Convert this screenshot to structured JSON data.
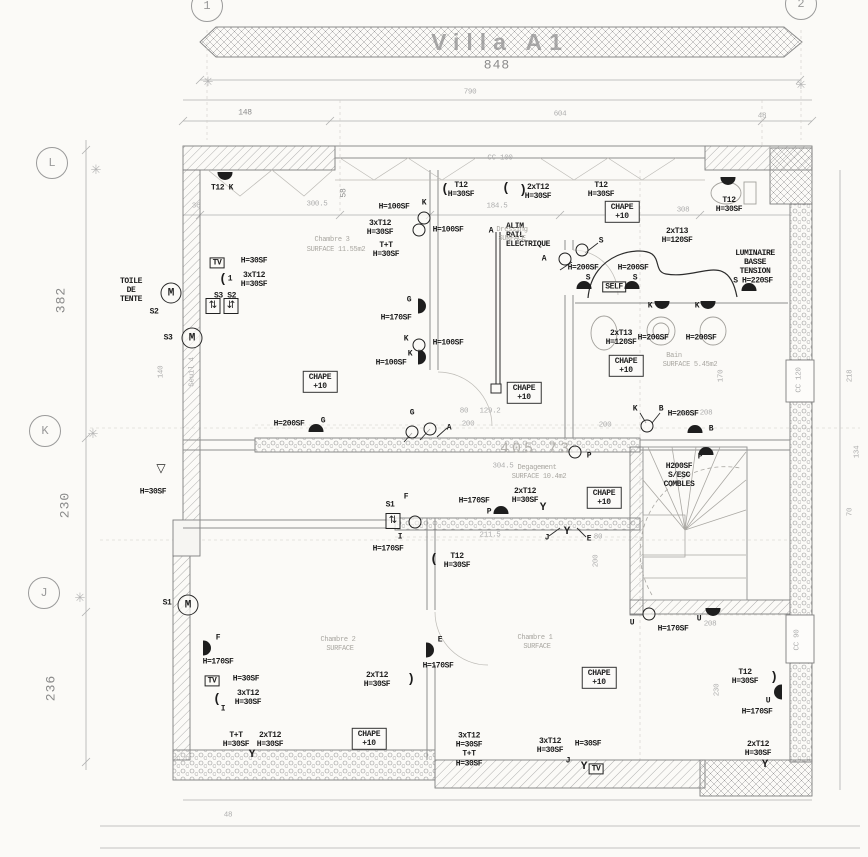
{
  "banner": {
    "title": "Villa A1"
  },
  "grid_bubbles": [
    {
      "label": "1",
      "x": 207,
      "y": 6
    },
    {
      "label": "2",
      "x": 801,
      "y": 4
    },
    {
      "label": "L",
      "x": 52,
      "y": 163
    },
    {
      "label": "K",
      "x": 45,
      "y": 431
    },
    {
      "label": "J",
      "x": 44,
      "y": 593
    }
  ],
  "survey_markers": [
    {
      "x": 208,
      "y": 82
    },
    {
      "x": 801,
      "y": 85
    },
    {
      "x": 96,
      "y": 170
    },
    {
      "x": 93,
      "y": 434
    },
    {
      "x": 80,
      "y": 598
    }
  ],
  "dimensions": [
    {
      "t": "848",
      "x": 497,
      "y": 66,
      "cls": "dim-big"
    },
    {
      "t": "790",
      "x": 470,
      "y": 93,
      "cls": "dim-faint"
    },
    {
      "t": "148",
      "x": 245,
      "y": 113,
      "cls": "dim"
    },
    {
      "t": "604",
      "x": 560,
      "y": 115,
      "cls": "dim-faint"
    },
    {
      "t": "48",
      "x": 762,
      "y": 117,
      "cls": "dim-faint"
    },
    {
      "t": "382",
      "x": 62,
      "y": 300,
      "cls": "dim-big",
      "rot": -90
    },
    {
      "t": "230",
      "x": 66,
      "y": 505,
      "cls": "dim-big",
      "rot": -90
    },
    {
      "t": "236",
      "x": 52,
      "y": 688,
      "cls": "dim-big",
      "rot": -90
    },
    {
      "t": "36",
      "x": 196,
      "y": 207,
      "cls": "dim-faint"
    },
    {
      "t": "300.5",
      "x": 317,
      "y": 205,
      "cls": "dim-faint"
    },
    {
      "t": "58",
      "x": 344,
      "y": 193,
      "cls": "dim",
      "rot": -90
    },
    {
      "t": "184.5",
      "x": 497,
      "y": 207,
      "cls": "dim-faint"
    },
    {
      "t": "CC 100",
      "x": 500,
      "y": 159,
      "cls": "dim-faint"
    },
    {
      "t": "308",
      "x": 683,
      "y": 211,
      "cls": "dim-faint"
    },
    {
      "t": "80",
      "x": 464,
      "y": 412,
      "cls": "dim-faint"
    },
    {
      "t": "129.2",
      "x": 490,
      "y": 412,
      "cls": "dim-faint"
    },
    {
      "t": "200",
      "x": 468,
      "y": 425,
      "cls": "dim-faint"
    },
    {
      "t": "76",
      "x": 682,
      "y": 415,
      "cls": "dim-faint"
    },
    {
      "t": "200",
      "x": 605,
      "y": 426,
      "cls": "dim-faint"
    },
    {
      "t": "208",
      "x": 706,
      "y": 414,
      "cls": "dim-faint"
    },
    {
      "t": "211.5",
      "x": 490,
      "y": 536,
      "cls": "dim-faint"
    },
    {
      "t": "80",
      "x": 598,
      "y": 538,
      "cls": "dim-faint"
    },
    {
      "t": "200",
      "x": 597,
      "y": 561,
      "cls": "dim-faint",
      "rot": -90
    },
    {
      "t": "170",
      "x": 722,
      "y": 376,
      "cls": "dim-faint",
      "rot": -90
    },
    {
      "t": "230",
      "x": 718,
      "y": 690,
      "cls": "dim-faint",
      "rot": -90
    },
    {
      "t": "208",
      "x": 710,
      "y": 625,
      "cls": "dim-faint"
    },
    {
      "t": "CC 120",
      "x": 800,
      "y": 380,
      "cls": "dim-faint",
      "rot": -90
    },
    {
      "t": "CC 90",
      "x": 798,
      "y": 640,
      "cls": "dim-faint",
      "rot": -90
    },
    {
      "t": "218",
      "x": 851,
      "y": 376,
      "cls": "dim-faint",
      "rot": -90
    },
    {
      "t": "134",
      "x": 858,
      "y": 452,
      "cls": "dim-faint",
      "rot": -90
    },
    {
      "t": "70",
      "x": 851,
      "y": 512,
      "cls": "dim-faint",
      "rot": -90
    },
    {
      "t": "140",
      "x": 162,
      "y": 372,
      "cls": "dim-faint",
      "rot": -90
    },
    {
      "t": "Seuil 4",
      "x": 193,
      "y": 372,
      "cls": "dim-faint",
      "rot": -90
    },
    {
      "t": "48",
      "x": 228,
      "y": 816,
      "cls": "dim-faint"
    },
    {
      "t": "304.5",
      "x": 503,
      "y": 467,
      "cls": "dim-faint"
    },
    {
      "t": "405 73",
      "x": 536,
      "y": 449,
      "cls": "dim-xl"
    }
  ],
  "room_labels": [
    {
      "t": "Chambre 3",
      "x": 332,
      "y": 240
    },
    {
      "t": "SURFACE  11.55m2",
      "x": 336,
      "y": 250
    },
    {
      "t": "Dressing",
      "x": 512,
      "y": 230
    },
    {
      "t": "SURFACE",
      "x": 512,
      "y": 239
    },
    {
      "t": "Degagement",
      "x": 537,
      "y": 468
    },
    {
      "t": "SURFACE  10.4m2",
      "x": 539,
      "y": 477
    },
    {
      "t": "Bain",
      "x": 674,
      "y": 356
    },
    {
      "t": "SURFACE  5.45m2",
      "x": 690,
      "y": 365
    },
    {
      "t": "Chambre 2",
      "x": 338,
      "y": 640
    },
    {
      "t": "SURFACE",
      "x": 340,
      "y": 649
    },
    {
      "t": "Chambre 1",
      "x": 535,
      "y": 638
    },
    {
      "t": "SURFACE",
      "x": 537,
      "y": 647
    }
  ],
  "chape": {
    "label": "CHAPE\n+10",
    "boxes": [
      {
        "x": 622,
        "y": 212
      },
      {
        "x": 320,
        "y": 382
      },
      {
        "x": 524,
        "y": 393
      },
      {
        "x": 626,
        "y": 366
      },
      {
        "x": 604,
        "y": 498
      },
      {
        "x": 369,
        "y": 739
      },
      {
        "x": 599,
        "y": 678
      }
    ]
  },
  "annotations": [
    {
      "t": "T12  K",
      "x": 222,
      "y": 188
    },
    {
      "t": "H=100SF",
      "x": 394,
      "y": 207
    },
    {
      "t": "K",
      "x": 424,
      "y": 203
    },
    {
      "t": "3xT12\nH=30SF",
      "x": 380,
      "y": 228
    },
    {
      "t": "T+T\nH=30SF",
      "x": 386,
      "y": 250
    },
    {
      "t": "H=100SF",
      "x": 448,
      "y": 230
    },
    {
      "t": "T12\nH=30SF",
      "x": 461,
      "y": 190
    },
    {
      "t": "2xT12\nH=30SF",
      "x": 538,
      "y": 192
    },
    {
      "t": "T12\nH=30SF",
      "x": 601,
      "y": 190
    },
    {
      "t": "T12\nH=30SF",
      "x": 729,
      "y": 205
    },
    {
      "t": "2xT13\nH=120SF",
      "x": 677,
      "y": 236
    },
    {
      "t": "ALIM\nRAIL\nELECTRIQUE",
      "x": 506,
      "y": 236,
      "a": "l"
    },
    {
      "t": "A",
      "x": 491,
      "y": 231
    },
    {
      "t": "A",
      "x": 544,
      "y": 259
    },
    {
      "t": "S",
      "x": 601,
      "y": 241
    },
    {
      "t": "H=200SF",
      "x": 583,
      "y": 268
    },
    {
      "t": "H=200SF",
      "x": 633,
      "y": 268
    },
    {
      "t": "S",
      "x": 588,
      "y": 278
    },
    {
      "t": "S",
      "x": 635,
      "y": 278
    },
    {
      "t": "SELF",
      "x": 614,
      "y": 287,
      "box": true
    },
    {
      "t": "LUMINAIRE\nBASSE\nTENSION",
      "x": 755,
      "y": 263
    },
    {
      "t": "S H=220SF",
      "x": 753,
      "y": 281
    },
    {
      "t": "K",
      "x": 650,
      "y": 306
    },
    {
      "t": "K",
      "x": 697,
      "y": 306
    },
    {
      "t": "2xT13\nH=120SF",
      "x": 621,
      "y": 338
    },
    {
      "t": "H=200SF",
      "x": 653,
      "y": 338
    },
    {
      "t": "H=200SF",
      "x": 701,
      "y": 338
    },
    {
      "t": "TV",
      "x": 217,
      "y": 263,
      "box": true
    },
    {
      "t": "H=30SF",
      "x": 254,
      "y": 261
    },
    {
      "t": "1",
      "x": 230,
      "y": 279
    },
    {
      "t": "3xT12\nH=30SF",
      "x": 254,
      "y": 280
    },
    {
      "t": "S3  S2",
      "x": 225,
      "y": 296
    },
    {
      "t": "TOILE\nDE\nTENTE",
      "x": 131,
      "y": 291
    },
    {
      "t": "S2",
      "x": 154,
      "y": 312
    },
    {
      "t": "S3",
      "x": 168,
      "y": 338
    },
    {
      "t": "H=30SF",
      "x": 153,
      "y": 492
    },
    {
      "t": "H=200SF",
      "x": 289,
      "y": 424
    },
    {
      "t": "G",
      "x": 323,
      "y": 421
    },
    {
      "t": "G",
      "x": 409,
      "y": 300
    },
    {
      "t": "H=170SF",
      "x": 396,
      "y": 318
    },
    {
      "t": "K",
      "x": 406,
      "y": 339
    },
    {
      "t": "H=100SF",
      "x": 448,
      "y": 343
    },
    {
      "t": "K",
      "x": 410,
      "y": 354
    },
    {
      "t": "H=100SF",
      "x": 391,
      "y": 363
    },
    {
      "t": "G",
      "x": 412,
      "y": 413
    },
    {
      "t": "A",
      "x": 449,
      "y": 428
    },
    {
      "t": "K",
      "x": 635,
      "y": 409
    },
    {
      "t": "B",
      "x": 661,
      "y": 409
    },
    {
      "t": "H=200SF",
      "x": 683,
      "y": 414
    },
    {
      "t": "P",
      "x": 589,
      "y": 456
    },
    {
      "t": "H200SF\nS/ESC\nCOMBLES",
      "x": 679,
      "y": 476
    },
    {
      "t": "P",
      "x": 700,
      "y": 457
    },
    {
      "t": "B",
      "x": 711,
      "y": 429
    },
    {
      "t": "H=170SF",
      "x": 474,
      "y": 501
    },
    {
      "t": "P",
      "x": 489,
      "y": 512
    },
    {
      "t": "2xT12\nH=30SF",
      "x": 525,
      "y": 496
    },
    {
      "t": "J",
      "x": 547,
      "y": 538
    },
    {
      "t": "E",
      "x": 589,
      "y": 539
    },
    {
      "t": "S1",
      "x": 390,
      "y": 505
    },
    {
      "t": "F",
      "x": 406,
      "y": 497
    },
    {
      "t": "I",
      "x": 400,
      "y": 537
    },
    {
      "t": "H=170SF",
      "x": 388,
      "y": 549
    },
    {
      "t": "T12\nH=30SF",
      "x": 457,
      "y": 561
    },
    {
      "t": "S1",
      "x": 167,
      "y": 603
    },
    {
      "t": "F",
      "x": 218,
      "y": 638
    },
    {
      "t": "H=170SF",
      "x": 218,
      "y": 662
    },
    {
      "t": "TV",
      "x": 212,
      "y": 681,
      "box": true
    },
    {
      "t": "H=30SF",
      "x": 246,
      "y": 679
    },
    {
      "t": "3xT12\nH=30SF",
      "x": 248,
      "y": 698
    },
    {
      "t": "I",
      "x": 223,
      "y": 709
    },
    {
      "t": "T+T\nH=30SF",
      "x": 236,
      "y": 740
    },
    {
      "t": "2xT12\nH=30SF",
      "x": 270,
      "y": 740
    },
    {
      "t": "2xT12\nH=30SF",
      "x": 377,
      "y": 680
    },
    {
      "t": "E",
      "x": 440,
      "y": 640
    },
    {
      "t": "H=170SF",
      "x": 438,
      "y": 666
    },
    {
      "t": "3xT12\nH=30SF\nT+T\nH=30SF",
      "x": 469,
      "y": 750
    },
    {
      "t": "3xT12\nH=30SF",
      "x": 550,
      "y": 746
    },
    {
      "t": "H=30SF",
      "x": 588,
      "y": 744
    },
    {
      "t": "J",
      "x": 568,
      "y": 761
    },
    {
      "t": "TV",
      "x": 596,
      "y": 769,
      "box": true
    },
    {
      "t": "U",
      "x": 632,
      "y": 623
    },
    {
      "t": "U",
      "x": 699,
      "y": 619
    },
    {
      "t": "H=170SF",
      "x": 673,
      "y": 629
    },
    {
      "t": "T12\nH=30SF",
      "x": 745,
      "y": 677
    },
    {
      "t": "U",
      "x": 768,
      "y": 701
    },
    {
      "t": "H=170SF",
      "x": 757,
      "y": 712
    },
    {
      "t": "2xT12\nH=30SF",
      "x": 758,
      "y": 749
    }
  ],
  "symbols": [
    {
      "k": "dome",
      "x": 316,
      "y": 428
    },
    {
      "k": "dome",
      "x": 422,
      "y": 306,
      "r": 90
    },
    {
      "k": "dome",
      "x": 422,
      "y": 357,
      "r": 90
    },
    {
      "k": "dome",
      "x": 501,
      "y": 510
    },
    {
      "k": "dome",
      "x": 584,
      "y": 285
    },
    {
      "k": "dome",
      "x": 632,
      "y": 285
    },
    {
      "k": "dome",
      "x": 749,
      "y": 287
    },
    {
      "k": "dome",
      "x": 662,
      "y": 305,
      "r": 180
    },
    {
      "k": "dome",
      "x": 708,
      "y": 305,
      "r": 180
    },
    {
      "k": "dome",
      "x": 207,
      "y": 648,
      "r": 90
    },
    {
      "k": "dome",
      "x": 430,
      "y": 650,
      "r": 90
    },
    {
      "k": "dome",
      "x": 706,
      "y": 451
    },
    {
      "k": "dome",
      "x": 695,
      "y": 429
    },
    {
      "k": "dome",
      "x": 713,
      "y": 612,
      "r": 180
    },
    {
      "k": "dome",
      "x": 778,
      "y": 692,
      "r": -90
    },
    {
      "k": "dome",
      "x": 225,
      "y": 176,
      "r": 180
    },
    {
      "k": "dome",
      "x": 728,
      "y": 181,
      "r": 180
    },
    {
      "k": "circle",
      "x": 419,
      "y": 345
    },
    {
      "k": "circle",
      "x": 424,
      "y": 218
    },
    {
      "k": "circle",
      "x": 419,
      "y": 230
    },
    {
      "k": "circle",
      "x": 412,
      "y": 432
    },
    {
      "k": "circle",
      "x": 430,
      "y": 429
    },
    {
      "k": "circle",
      "x": 647,
      "y": 426
    },
    {
      "k": "circle",
      "x": 575,
      "y": 452
    },
    {
      "k": "circle",
      "x": 415,
      "y": 522
    },
    {
      "k": "circle",
      "x": 649,
      "y": 614
    },
    {
      "k": "circle",
      "x": 565,
      "y": 259
    },
    {
      "k": "circle",
      "x": 582,
      "y": 250
    },
    {
      "k": "mcircle",
      "x": 171,
      "y": 293,
      "t": "M"
    },
    {
      "k": "mcircle",
      "x": 192,
      "y": 338,
      "t": "M"
    },
    {
      "k": "mcircle",
      "x": 188,
      "y": 605,
      "t": "M"
    },
    {
      "k": "abox",
      "x": 213,
      "y": 306,
      "t": "⇅"
    },
    {
      "k": "abox",
      "x": 231,
      "y": 306,
      "t": "⇵"
    },
    {
      "k": "abox",
      "x": 393,
      "y": 521,
      "t": "⇅"
    },
    {
      "k": "tri",
      "x": 161,
      "y": 468,
      "t": "▽"
    },
    {
      "k": "yant",
      "x": 543,
      "y": 508,
      "t": "Y"
    },
    {
      "k": "yant",
      "x": 567,
      "y": 532,
      "t": "Y"
    },
    {
      "k": "yant",
      "x": 584,
      "y": 767,
      "t": "Y"
    },
    {
      "k": "yant",
      "x": 765,
      "y": 765,
      "t": "Y"
    },
    {
      "k": "yant",
      "x": 252,
      "y": 755,
      "t": "Y"
    },
    {
      "k": "arc",
      "x": 434,
      "y": 559,
      "t": "("
    },
    {
      "k": "arc",
      "x": 217,
      "y": 699,
      "t": "("
    },
    {
      "k": "arc",
      "x": 223,
      "y": 279,
      "t": "("
    },
    {
      "k": "arc",
      "x": 411,
      "y": 679,
      "t": ")"
    },
    {
      "k": "arc",
      "x": 774,
      "y": 677,
      "t": ")"
    },
    {
      "k": "arc",
      "x": 445,
      "y": 189,
      "t": "("
    },
    {
      "k": "arc",
      "x": 506,
      "y": 188,
      "t": "("
    },
    {
      "k": "arc",
      "x": 523,
      "y": 190,
      "t": ")"
    }
  ]
}
